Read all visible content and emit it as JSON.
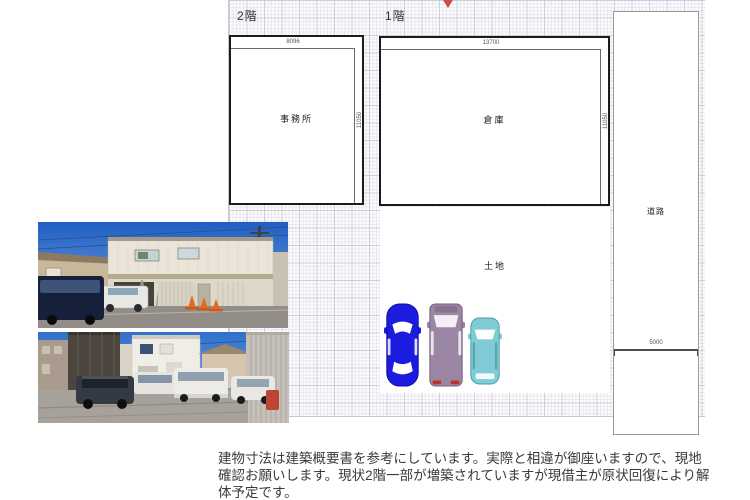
{
  "plan": {
    "floor2": {
      "label": "2階",
      "room": "事務所",
      "width_dim": "8096",
      "height_dim": "11050"
    },
    "floor1": {
      "label": "1階",
      "room": "倉庫",
      "width_dim": "13700",
      "height_dim": "11050"
    },
    "land": {
      "label": "土地"
    },
    "road": {
      "label": "道路",
      "bottom_dim": "5000"
    }
  },
  "cars": [
    {
      "name": "blue-sedan",
      "color": "#1c1cdf",
      "accent": "#ffffff"
    },
    {
      "name": "purple-van",
      "color": "#9b87a3",
      "accent": "#f2f0f4"
    },
    {
      "name": "teal-compact",
      "color": "#7fccd6",
      "accent": "#fdfefe"
    }
  ],
  "colors": {
    "wall_line": "#1b1b1b",
    "grid_major": "#cfccdb",
    "marker_red": "#c6504a",
    "taillight_red": "#c03028"
  },
  "note": {
    "text": "建物寸法は建築概要書を参考にしています。実際と相違が御座いますので、現地確認お願いします。現状2階一部が増築されていますが現借主が原状回復により解体予定です。"
  }
}
